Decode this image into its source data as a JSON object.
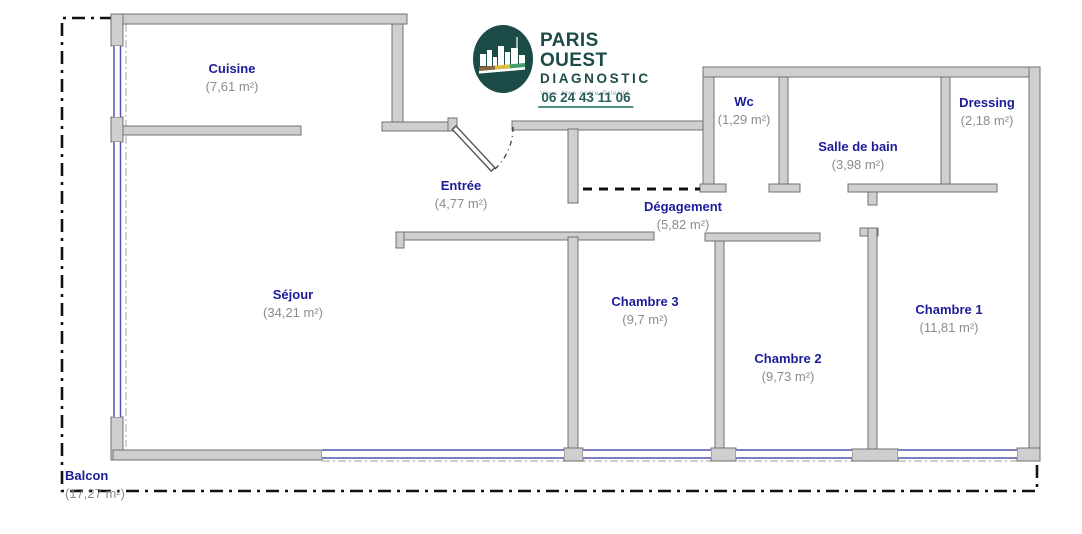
{
  "logo": {
    "brand_line1": "PARIS OUEST",
    "brand_line2": "DIAGNOSTIC",
    "tagline_regular": "Vous êtes notre",
    "tagline_italic": "Priorité.",
    "phone": "06 24 43 11 06"
  },
  "rooms": {
    "cuisine": {
      "name": "Cuisine",
      "area": "(7,61 m²)"
    },
    "entree": {
      "name": "Entrée",
      "area": "(4,77 m²)"
    },
    "wc": {
      "name": "Wc",
      "area": "(1,29 m²)"
    },
    "salle_de_bain": {
      "name": "Salle de bain",
      "area": "(3,98 m²)"
    },
    "dressing": {
      "name": "Dressing",
      "area": "(2,18 m²)"
    },
    "degagement": {
      "name": "Dégagement",
      "area": "(5,82 m²)"
    },
    "sejour": {
      "name": "Séjour",
      "area": "(34,21 m²)"
    },
    "chambre3": {
      "name": "Chambre 3",
      "area": "(9,7 m²)"
    },
    "chambre2": {
      "name": "Chambre 2",
      "area": "(9,73 m²)"
    },
    "chambre1": {
      "name": "Chambre 1",
      "area": "(11,81 m²)"
    },
    "balcon": {
      "name": "Balcon",
      "area": "(17,27 m²)"
    }
  },
  "colors": {
    "room_name": "#1c1c99",
    "room_area": "#8c8c8c",
    "wall_fill": "#cfcfcf",
    "wall_stroke": "#707070",
    "window_blue": "#5252ad",
    "balcony_outline": "#111111",
    "edge_gray": "#b5b5b5",
    "logo_oval": "#1c4a46",
    "logo_brand": "#1d4b47",
    "logo_tagline": "#9aa0a0",
    "logo_phone": "#26605c",
    "logo_underline": "#4a8f85"
  }
}
